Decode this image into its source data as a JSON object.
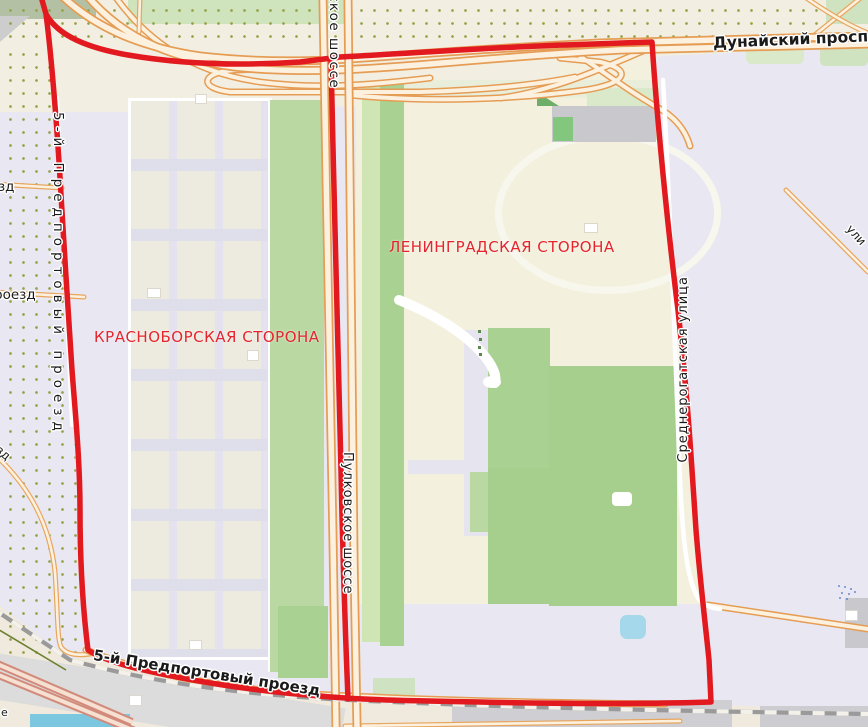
{
  "map": {
    "type": "street-map with selection overlay",
    "labels": {
      "areas": {
        "krasnoborskaya": "КРАСНОБОРСКАЯ СТОРОНА",
        "leningradskaya": "ЛЕНИНГРАДСКАЯ СТОРОНА"
      },
      "streets": {
        "dunaysky": "Дунайский проспект",
        "pulkovskoye_partial": "ское шоссе",
        "pulkovskoye": "Пулковское шоссе",
        "predportovy_vertical": "5-й Предпортовый проезд",
        "predportovy_bottom": "5-й Предпортовый проезд",
        "srednerogatskaya": "Среднерогатская улица",
        "fragment_zd_upper": "зд",
        "fragment_roezd": "роезд",
        "fragment_zd_diагonal": "зд",
        "fragment_uli": "ули",
        "fragment_e": "е"
      }
    },
    "colors": {
      "boundary_red": "#e2191e",
      "area_label_red": "#e6242d",
      "road_casing_orange": "#e59d55",
      "road_fill_cream": "#fcf1df",
      "motorway_salmon": "#d28a7b",
      "green_dark": "#a6cf8e",
      "green_light": "#cfe5b4",
      "water_blue": "#a5d8ea",
      "background_lavender": "#e9e8f2",
      "background_cream": "#f2efe2",
      "allotment_dot_olive": "#96a147",
      "railway_gray": "#9a9a9a"
    }
  }
}
